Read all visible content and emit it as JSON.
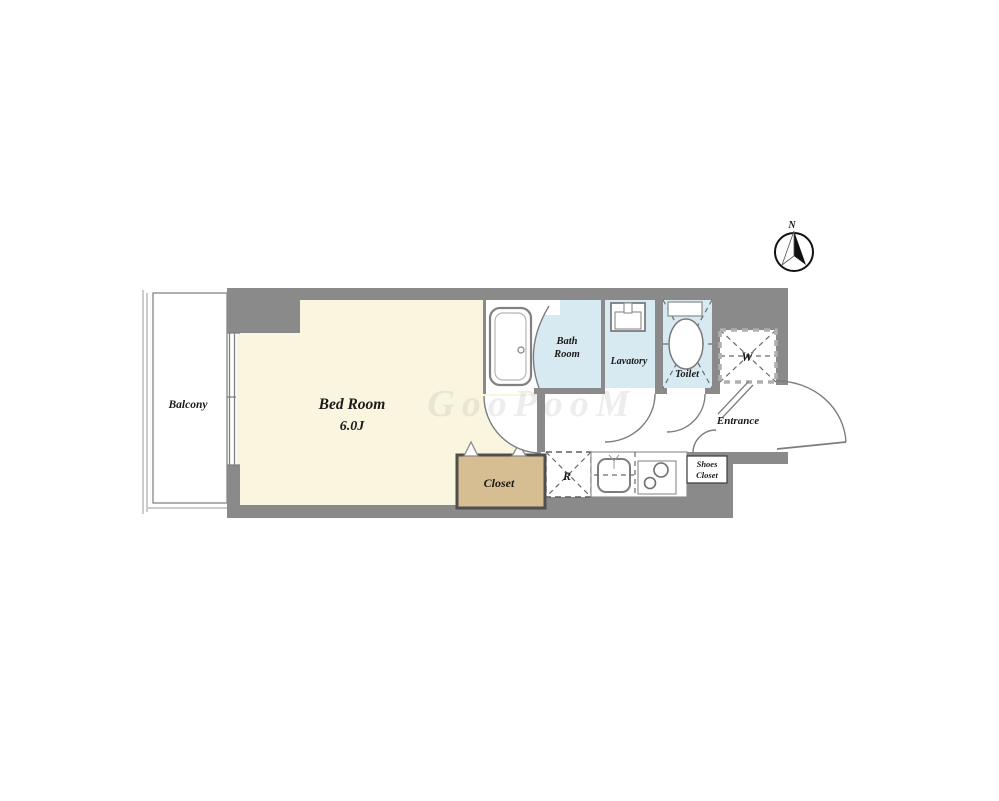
{
  "title": "1K apartment floor plan",
  "colors": {
    "background": "#ffffff",
    "wall": "#8a8a8a",
    "bedroom_floor": "#f9f5df",
    "closet_floor": "#d7be92",
    "wet_floor": "#d8eaf1",
    "text": "#1a1a1a"
  },
  "compass": {
    "north_label": "N"
  },
  "watermark": {
    "text": "GooPooM"
  },
  "rooms": {
    "balcony": {
      "label": "Balcony"
    },
    "bedroom": {
      "label": "Bed Room",
      "size": "6.0J"
    },
    "closet": {
      "label": "Closet"
    },
    "bath": {
      "label_line1": "Bath",
      "label_line2": "Room"
    },
    "lavatory": {
      "label": "Lavatory"
    },
    "toilet": {
      "label": "Toilet"
    },
    "wardrobe": {
      "label": "W"
    },
    "refrigerator": {
      "label": "R"
    },
    "kitchen": {
      "note": ""
    },
    "shoes_closet": {
      "label_line1": "Shoes",
      "label_line2": "Closet"
    },
    "entrance": {
      "label": "Entrance"
    }
  }
}
